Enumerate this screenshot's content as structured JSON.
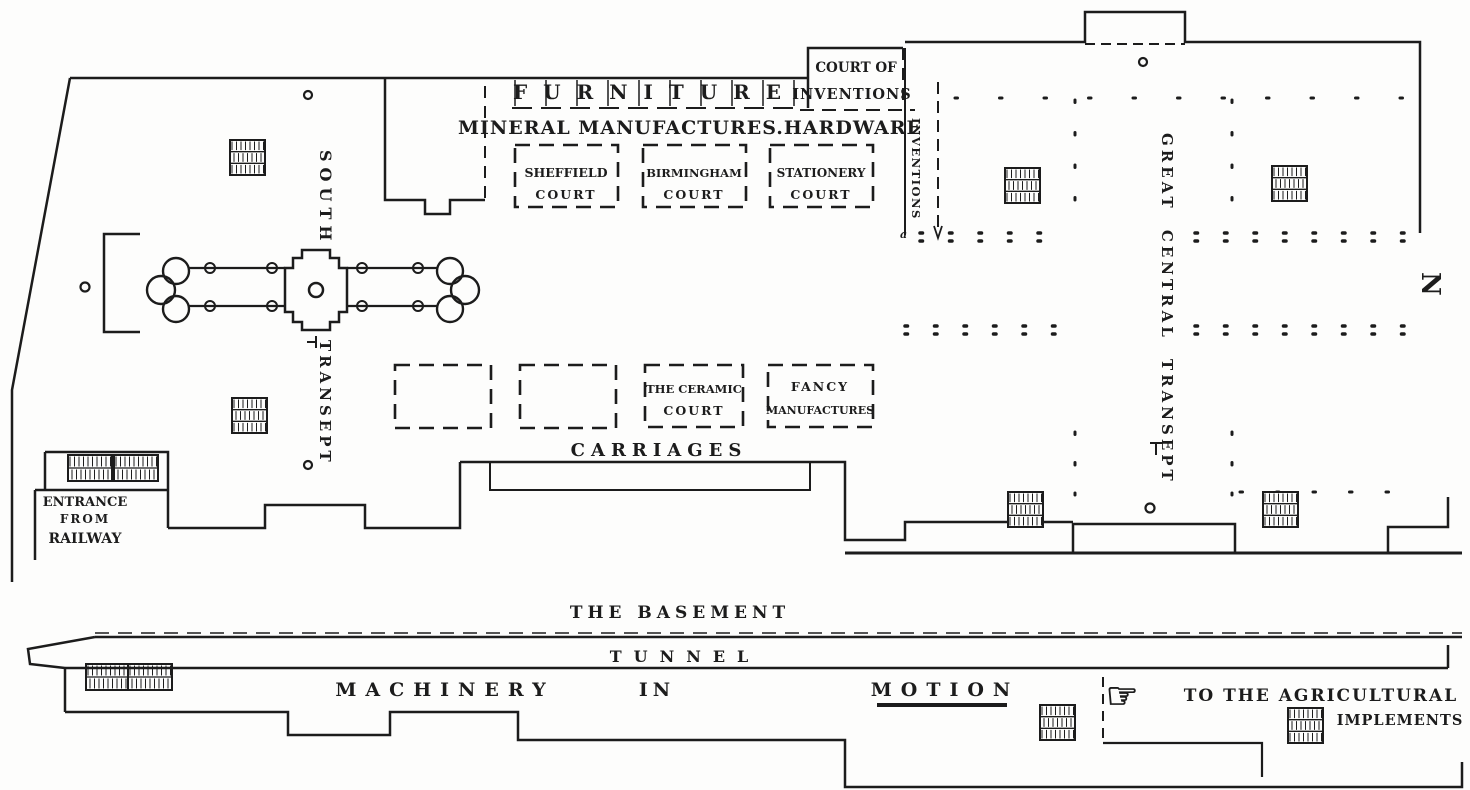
{
  "plan": {
    "labels": {
      "furniture": "FURNITURE",
      "mineral_hardware": "MINERAL MANUFACTURES.HARDWARE",
      "court_of": "COURT OF",
      "inventions_top": "INVENTIONS",
      "sheffield_line1": "SHEFFIELD",
      "sheffield_line2": "COURT",
      "birmingham_line1": "BIRMINGHAM",
      "birmingham_line2": "COURT",
      "stationery_line1": "STATIONERY",
      "stationery_line2": "COURT",
      "south": "SOUTH",
      "transept": "TRANSEPT",
      "inventions_vertical": "INVENTIONS",
      "great_central_transept": "GREAT CENTRAL TRANSEPT",
      "north_compass": "N",
      "ceramic_line1": "THE CERAMIC",
      "ceramic_line2": "COURT",
      "fancy_line1": "FANCY",
      "fancy_line2": "MANUFACTURES",
      "carriages": "CARRIAGES",
      "entrance_line1": "ENTRANCE",
      "entrance_line2": "FROM",
      "entrance_line3": "RAILWAY",
      "the_basement": "THE BASEMENT",
      "tunnel": "TUNNEL",
      "machinery": "MACHINERY",
      "in_word": "IN",
      "motion": "MOTION",
      "to_the_agricultural": "TO THE AGRICULTURAL",
      "implements": "IMPLEMENTS",
      "hand_glyph": "☞",
      "reference_mark_a": "a"
    },
    "icons": {
      "stairs": "stairs-icon",
      "pointing_hand": "pointing-hand-icon"
    },
    "colors": {
      "ink": "#1c1c1c",
      "paper": "#fdfdfc"
    }
  }
}
